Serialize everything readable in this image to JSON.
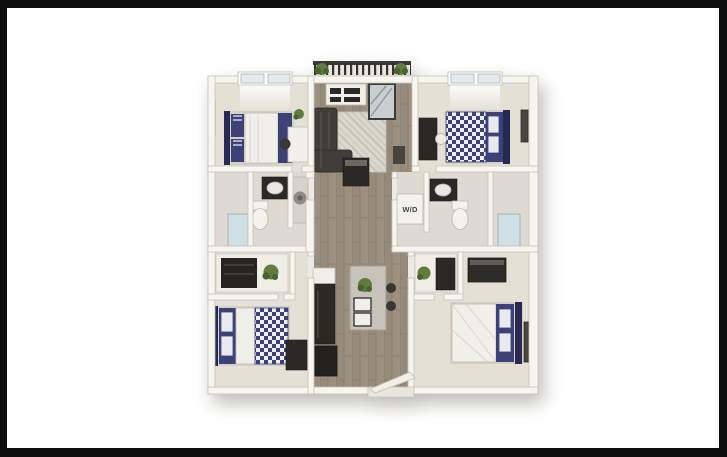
{
  "frame": {
    "background": "#0e0e0e",
    "canvas_background": "#ffffff"
  },
  "floorplan": {
    "kind": "3d-floor-plan-render",
    "labels": {
      "washer_dryer": "W/D"
    },
    "colors": {
      "wall": "#f7f5f0",
      "wall_edge": "#c9c3b6",
      "carpet": "#e4e0d6",
      "bath_tile": "#dedad2",
      "wood_floor": "#9c9180",
      "navy_bedding": "#3c4277",
      "dark_furniture": "#2b2926",
      "plant_green": "#5f7d3f",
      "window_glass": "#cfdfe6",
      "railing": "#33322f"
    }
  }
}
